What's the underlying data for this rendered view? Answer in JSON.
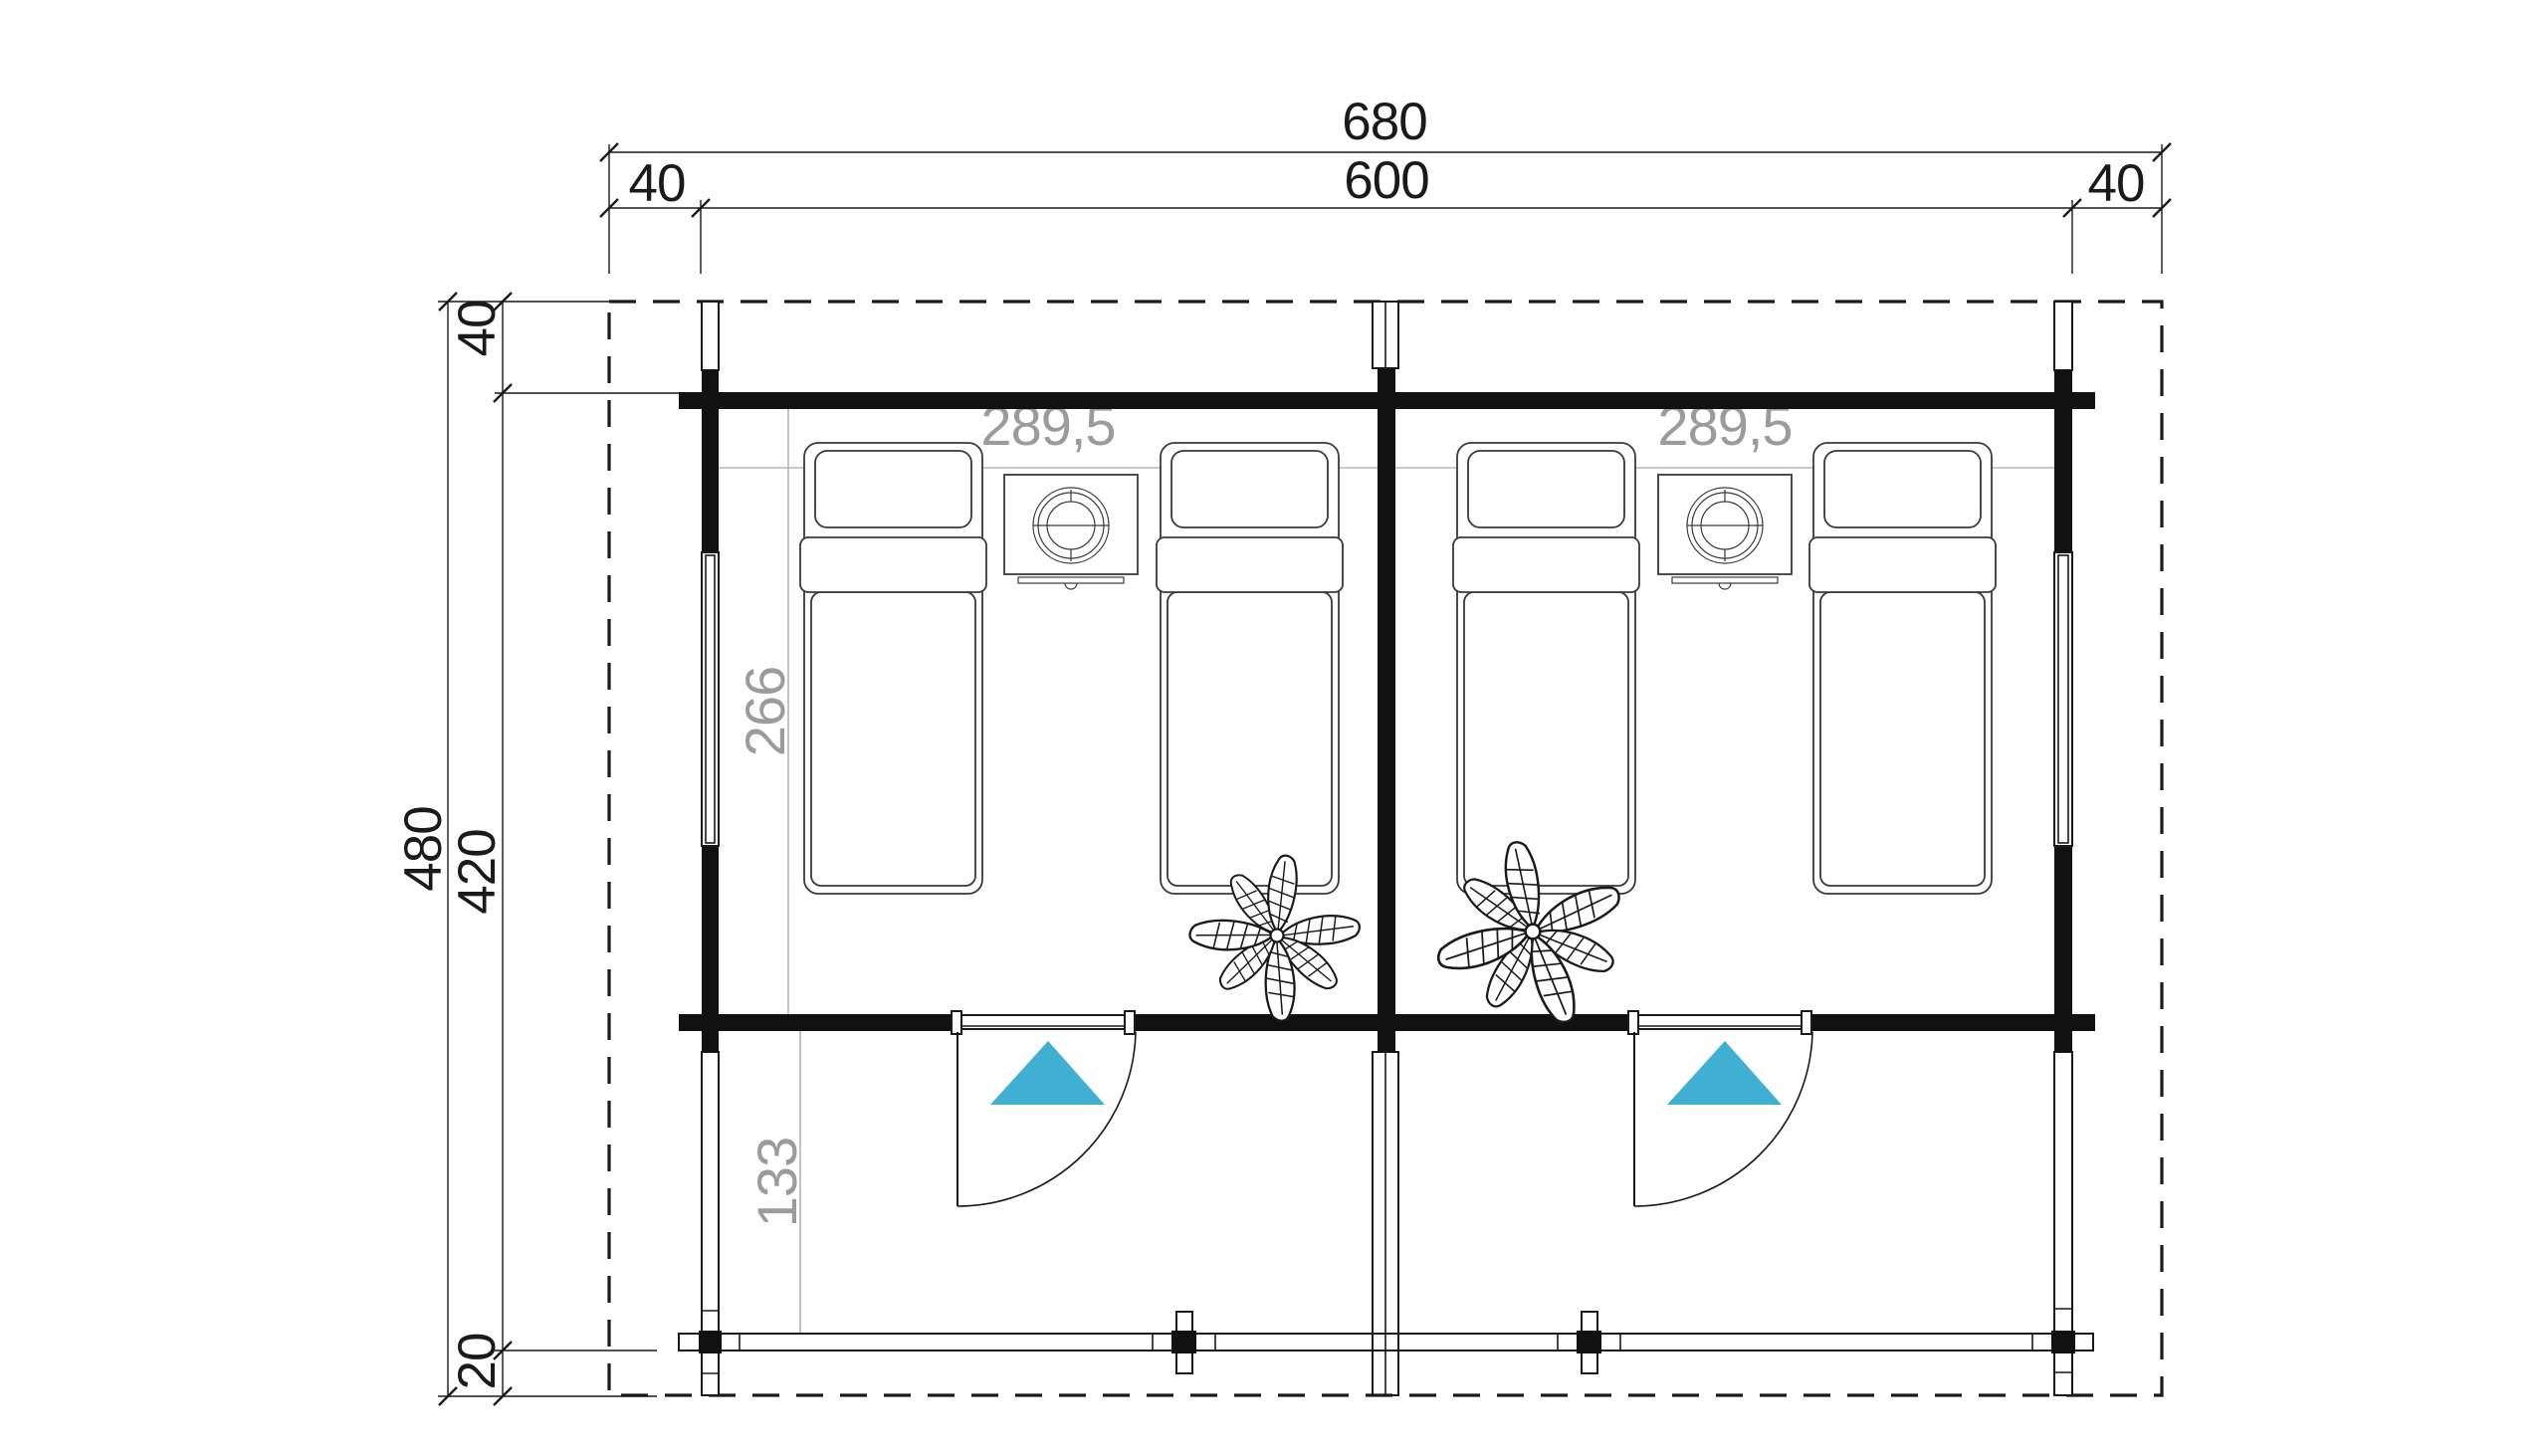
{
  "drawing": {
    "kind": "twin cabin floor plan",
    "colors": {
      "line": "#1a1a1a",
      "grey_text": "#9b9b9b",
      "grey_line": "#b6b6b6",
      "accent": "#3fafd2"
    },
    "labels": {
      "overall_width": "680",
      "inner_width": "600",
      "margin_left": "40",
      "margin_right": "40",
      "overall_depth": "480",
      "margin_top": "40",
      "inner_depth": "420",
      "margin_bottom": "20",
      "room_left_width": "289,5",
      "room_right_width": "289,5",
      "room_interior_depth": "266",
      "veranda_depth": "133"
    }
  }
}
